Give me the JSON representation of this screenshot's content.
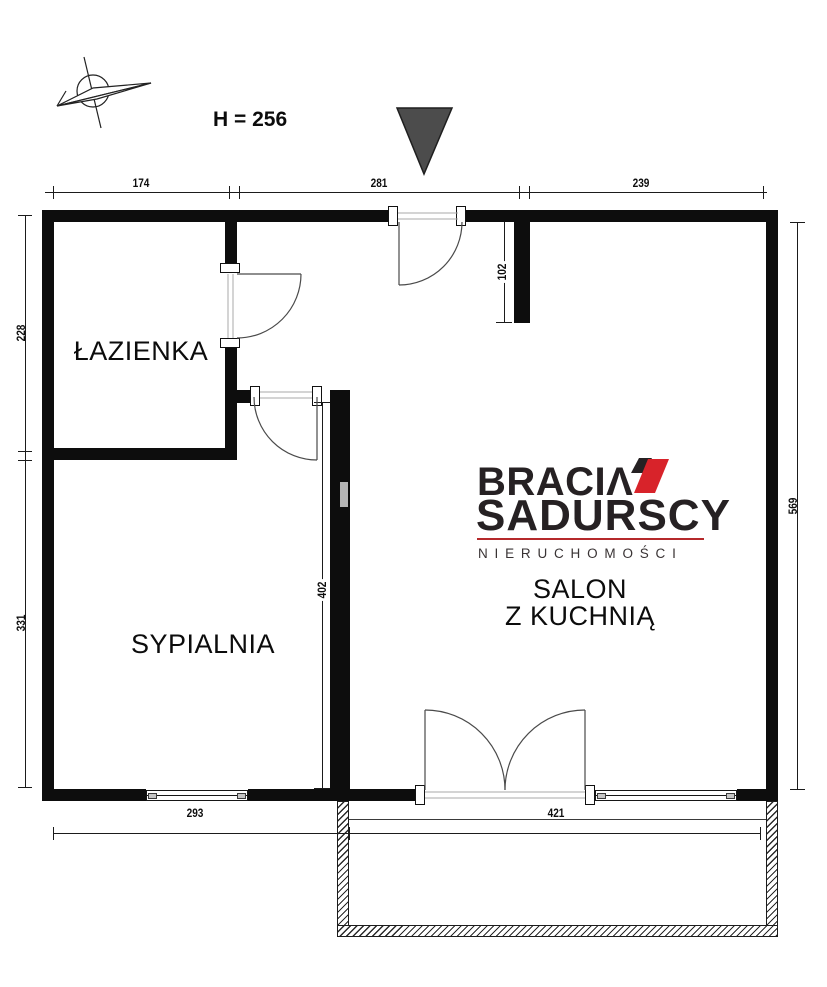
{
  "header": {
    "height_label": "H = 256"
  },
  "logo": {
    "brand_top": "BRACIΛ",
    "brand_bottom": "SADURSCY",
    "tagline": "NIERUCHOMOŚCI",
    "accent_red": "#d8232a",
    "text_dark": "#262123"
  },
  "rooms": {
    "bathroom": "ŁAZIENKA",
    "bedroom": "SYPIALNIA",
    "living": [
      "SALON",
      "Z KUCHNIĄ"
    ]
  },
  "dimensions": {
    "top": [
      "174",
      "281",
      "239"
    ],
    "left": [
      "228",
      "331"
    ],
    "right": [
      "569"
    ],
    "bottom": [
      "293",
      "421"
    ],
    "interior": {
      "entry_depth": "102",
      "bedroom_wall": "402"
    }
  },
  "colors": {
    "wall": "#0d0d0d",
    "dimension_line": "#1b1b1b",
    "entrance_triangle": "#4c4c4c",
    "window_cap": "#c6c6c6"
  }
}
